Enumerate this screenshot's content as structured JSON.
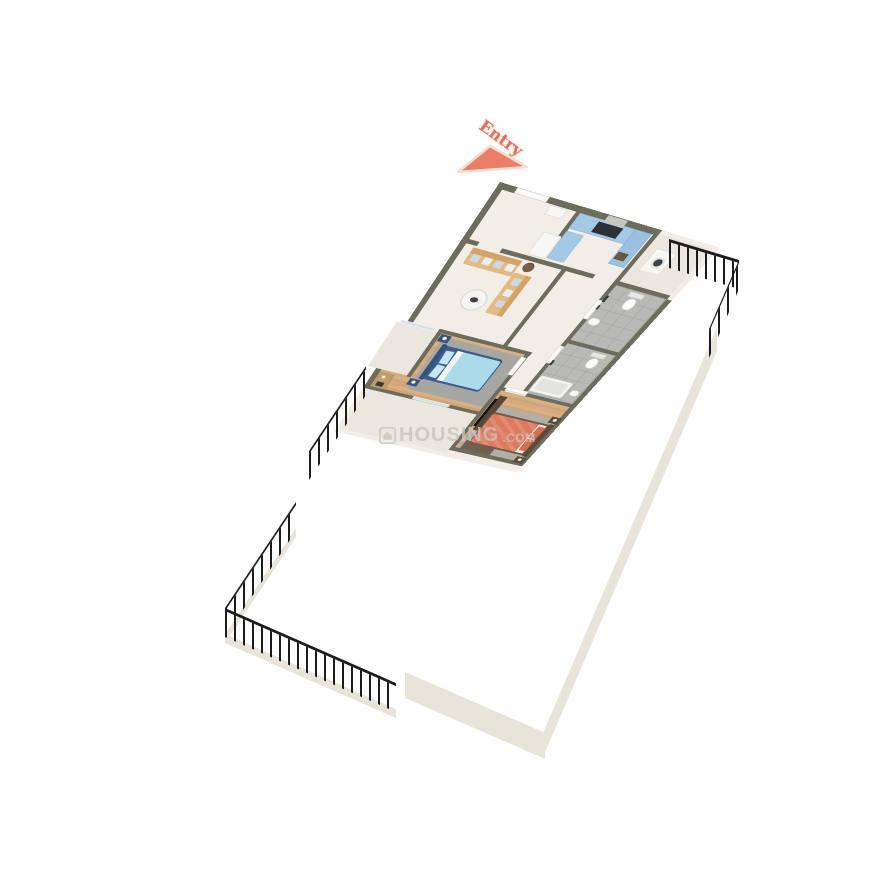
{
  "scene": {
    "entry_label": "Entry"
  },
  "watermark": {
    "icon": "house-icon",
    "brand": "HOUSING",
    "tld": ".COM"
  },
  "palette": {
    "page_bg": "#ffffff",
    "wall": "#6d6d5d",
    "wall_face": "#e9e4da",
    "marble": "#f2eee7",
    "marble_balcony": "#ece7de",
    "wood_a": "#d8b084",
    "wood_b": "#cfa476",
    "tile": "#b9bab5",
    "tile_line": "#a6a7a1",
    "cabinet_blue": "#a3c9e4",
    "cabinet_blue_dark": "#9ac2e0",
    "counter_dark": "#2e3236",
    "sofa": "#e3ba82",
    "sofa_back": "#d3a468",
    "pillow_blue": "#cdd9e2",
    "bed1_frame": "#3e5c8d",
    "bed1_duvet": "#abdae8",
    "bed1_pillow": "#c6e7f1",
    "bed2_frame": "#6f5c4a",
    "bed2_duvet": "#de7a5e",
    "bed2_pillow": "#d86f52",
    "rug_gray": "#a7a7a1",
    "rug_warm": "#b2afa8",
    "railing": "#1c1c1c",
    "glass": "#cfe3ee",
    "door": "#fbfaf7",
    "entry": "#e0705a",
    "watermark": "#c9c4bd",
    "white_goods": "#f7f7f4",
    "wood_furniture": "#584737",
    "tile_fixture": "#3a3a3a",
    "tub": "#f5f5f2",
    "mat_brown": "#70614f",
    "shelf_wood": "#c49e6a"
  }
}
